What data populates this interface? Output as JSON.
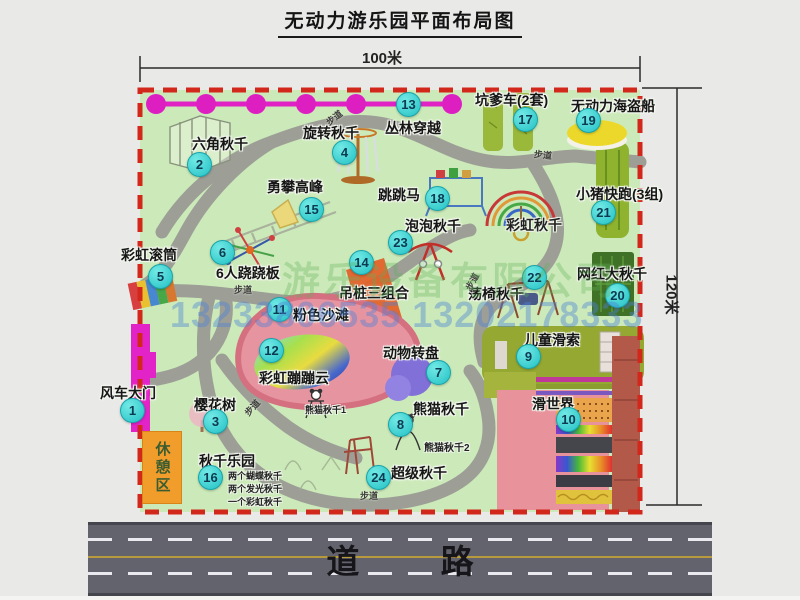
{
  "title": "无动力游乐园平面布局图",
  "dim": {
    "width": "100米",
    "height": "120米"
  },
  "road": "道 路",
  "rest_area": "休憩区",
  "path_label": "步道",
  "watermark": {
    "company": "游乐设备有限公司",
    "phone": "13233806535 13202178333"
  },
  "sub": {
    "rainbow_swing": "彩虹秋千",
    "panda1": "熊猫秋千1",
    "panda2": "熊猫秋千2",
    "swing_lines": [
      "两个蝴蝶秋千",
      "两个发光秋千",
      "一个彩虹秋千"
    ]
  },
  "colors": {
    "park_green": "#cceab9",
    "border_red": "#d2271b",
    "badge_cyan": "#23c0c4",
    "gate_magenta": "#e223c8",
    "road_gray": "#63636d",
    "beach_pink": "#e794a1"
  },
  "items": [
    {
      "num": 1,
      "label": "风车大门",
      "lx": 100,
      "ly": 383,
      "bx": 120,
      "by": 398
    },
    {
      "num": 2,
      "label": "六角秋千",
      "lx": 192,
      "ly": 134,
      "bx": 187,
      "by": 152
    },
    {
      "num": 3,
      "label": "樱花树",
      "lx": 194,
      "ly": 395,
      "bx": 203,
      "by": 409
    },
    {
      "num": 4,
      "label": "旋转秋千",
      "lx": 303,
      "ly": 123,
      "bx": 332,
      "by": 140
    },
    {
      "num": 5,
      "label": "彩虹滚筒",
      "lx": 121,
      "ly": 245,
      "bx": 148,
      "by": 264
    },
    {
      "num": 6,
      "label": "6人跷跷板",
      "lx": 216,
      "ly": 263,
      "bx": 210,
      "by": 240
    },
    {
      "num": 7,
      "label": "动物转盘",
      "lx": 383,
      "ly": 343,
      "bx": 426,
      "by": 360
    },
    {
      "num": 8,
      "label": "熊猫秋千",
      "lx": 413,
      "ly": 399,
      "bx": 388,
      "by": 412
    },
    {
      "num": 9,
      "label": "儿童滑索",
      "lx": 524,
      "ly": 330,
      "bx": 516,
      "by": 344
    },
    {
      "num": 10,
      "label": "滑世界",
      "lx": 532,
      "ly": 394,
      "bx": 556,
      "by": 407
    },
    {
      "num": 11,
      "label": "粉色沙滩",
      "lx": 293,
      "ly": 305,
      "bx": 267,
      "by": 297
    },
    {
      "num": 12,
      "label": "彩虹蹦蹦云",
      "lx": 259,
      "ly": 368,
      "bx": 259,
      "by": 338
    },
    {
      "num": 13,
      "label": "丛林穿越",
      "lx": 385,
      "ly": 118,
      "bx": 396,
      "by": 92
    },
    {
      "num": 14,
      "label": "吊桩三组合",
      "lx": 339,
      "ly": 283,
      "bx": 349,
      "by": 250
    },
    {
      "num": 15,
      "label": "勇攀高峰",
      "lx": 267,
      "ly": 177,
      "bx": 299,
      "by": 197
    },
    {
      "num": 16,
      "label": "秋千乐园",
      "lx": 199,
      "ly": 451,
      "bx": 198,
      "by": 465
    },
    {
      "num": 17,
      "label": "坑爹车(2套)",
      "lx": 475,
      "ly": 90,
      "bx": 513,
      "by": 107
    },
    {
      "num": 18,
      "label": "跳跳马",
      "lx": 378,
      "ly": 185,
      "bx": 425,
      "by": 186
    },
    {
      "num": 19,
      "label": "无动力海盗船",
      "lx": 571,
      "ly": 96,
      "bx": 576,
      "by": 108
    },
    {
      "num": 20,
      "label": "网红大秋千",
      "lx": 577,
      "ly": 264,
      "bx": 605,
      "by": 283
    },
    {
      "num": 21,
      "label": "小猪快跑(3组)",
      "lx": 576,
      "ly": 184,
      "bx": 591,
      "by": 200
    },
    {
      "num": 22,
      "label": "荡椅秋千",
      "lx": 468,
      "ly": 284,
      "bx": 522,
      "by": 265
    },
    {
      "num": 23,
      "label": "泡泡秋千",
      "lx": 405,
      "ly": 216,
      "bx": 388,
      "by": 230
    },
    {
      "num": 24,
      "label": "超级秋千",
      "lx": 391,
      "ly": 463,
      "bx": 366,
      "by": 465
    }
  ]
}
